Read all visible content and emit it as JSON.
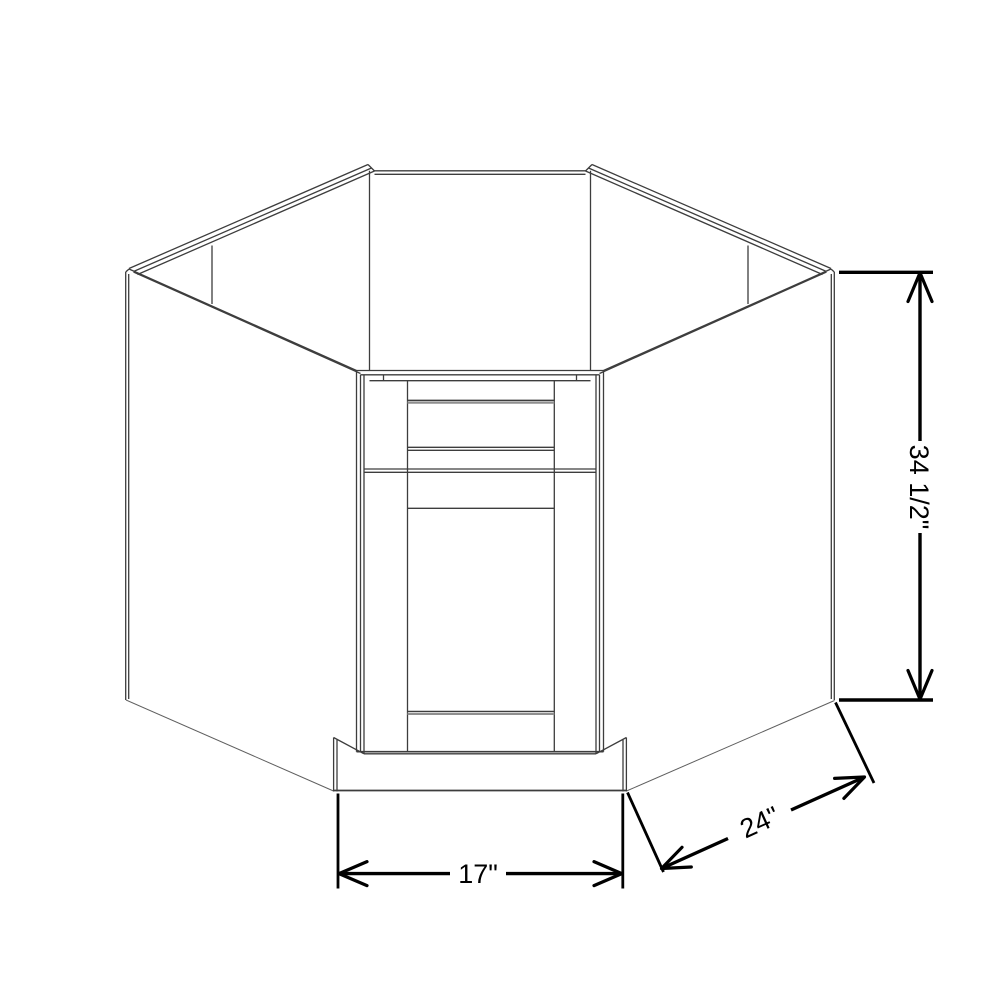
{
  "diagram": {
    "dimensions": {
      "height": "34 1/2\"",
      "depth": "24\"",
      "width": "17\""
    },
    "colors": {
      "background": "#ffffff",
      "cabinet_line": "#3d3d3d",
      "shadow_line": "#8f8f8f",
      "dimension": "#000000"
    }
  }
}
